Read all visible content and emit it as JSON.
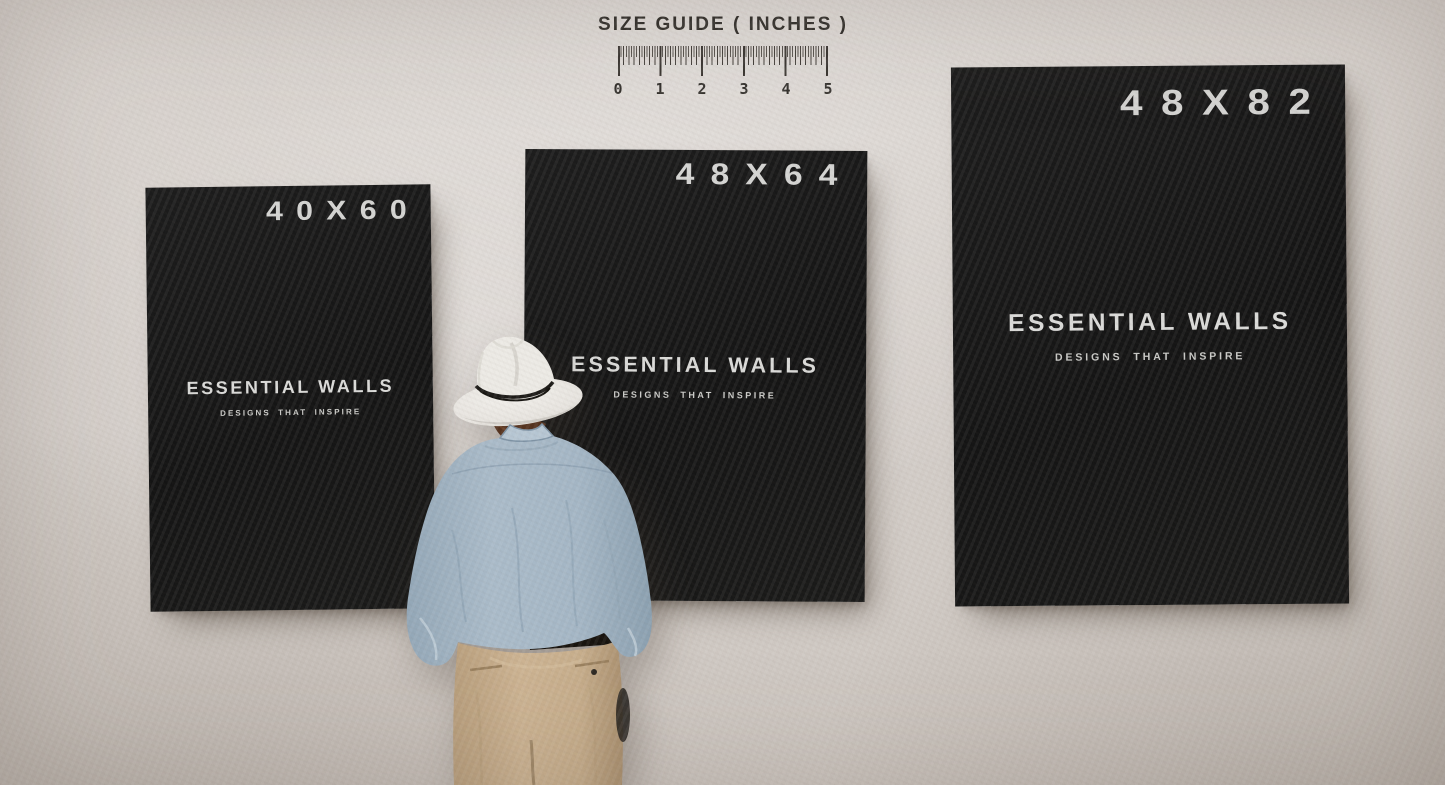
{
  "size_guide": {
    "title": "SIZE GUIDE ( INCHES )",
    "unit_numbers": [
      "0",
      "1",
      "2",
      "3",
      "4",
      "5"
    ]
  },
  "posters": [
    {
      "size_label": "40X60",
      "brand_title": "ESSENTIAL WALLS",
      "brand_tagline": "DESIGNS THAT INSPIRE"
    },
    {
      "size_label": "48X64",
      "brand_title": "ESSENTIAL WALLS",
      "brand_tagline": "DESIGNS THAT INSPIRE"
    },
    {
      "size_label": "48X82",
      "brand_title": "ESSENTIAL WALLS",
      "brand_tagline": "DESIGNS THAT INSPIRE"
    }
  ],
  "figure": {
    "label": "man viewed from behind wearing white fedora, blue shirt, khaki trousers"
  },
  "colors": {
    "wall": "#d3cdc8",
    "poster_black": "#161616",
    "poster_text": "#d9d9d6",
    "ruler_ink": "#3b3733",
    "hat": "#eceae5",
    "hat_band": "#1c1a17",
    "hair": "#54321e",
    "shirt_blue": "#a9bac8",
    "trousers_khaki": "#c9b190",
    "belt": "#17130e"
  }
}
